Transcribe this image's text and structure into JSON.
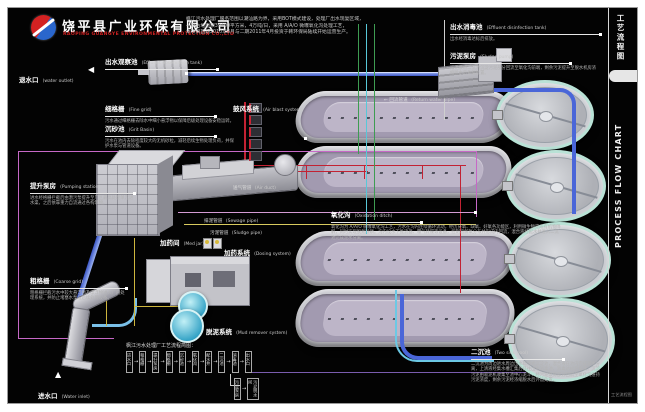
{
  "header": {
    "company_cn": "饶平县广业环保有限公司",
    "company_en": "RAOPING GUANGYE ENVIRONMENTAL PROTECTION CO.,LTD",
    "description_lines": [
      "枫江污水处理厂服务范围以潮汕路为界，采用BOT模式建设，处理厂出水现复区域，",
      "一期占地面积39400平方米，4万吨/日，采用 A/A/O 微曝氧化沟处理工艺，",
      "本项目首期2010年3月与二期2011年4月投资于韩环保局陆续开始运营生产。"
    ]
  },
  "sidebar": {
    "title_cn": "工艺流程图",
    "title_en": "PROCESS FLOW CHART",
    "footer": "工艺流程图"
  },
  "labels": {
    "observation_tank": {
      "cn": "出水观察池",
      "en": "(Effluent observation tank)"
    },
    "water_outlet": {
      "cn": "退水口",
      "en": "(water outlet)",
      "arrow": "◀"
    },
    "fine_grid": {
      "cn": "细格栅",
      "en": "(Fine grid)",
      "desc": "污水通过细格栅去除水中细小悬浮物以保障后级处理设备安稳运转。"
    },
    "grit_basin": {
      "cn": "沉砂池",
      "en": "(Grit Basin)",
      "desc": "污水在池内去除密度较大的无机砂粒，减轻后续生物处理负荷，并保护水泵与管道设备。"
    },
    "air_blast": {
      "cn": "鼓风系统",
      "en": "(Air blast system)"
    },
    "air_duct": {
      "cn": "送气管道",
      "en": "(Air duct)"
    },
    "pumping_station": {
      "cn": "提升泵房",
      "en": "(Pumping station)",
      "desc": "进水经格栅拦截后由潜污泵提升至厂区最高处理单元进水渠，之后依靠重力自流通过各构筑物。"
    },
    "coarse_grid": {
      "cn": "粗格栅",
      "en": "(Coarse grid)",
      "desc": "粗格栅拦截污水中较大悬浮物及漂浮物进入厂内处理系统，并防止堵塞水泵与后续处理设备。"
    },
    "water_inlet": {
      "cn": "进水口",
      "en": "(Water inlet)",
      "arrow": "▲"
    },
    "sewage_pipe": {
      "cn": "排泥管道",
      "en": "(Sewage pipe)"
    },
    "sludge_pipe": {
      "cn": "污泥管道",
      "en": "(Sludge pipe)"
    },
    "med_jar": {
      "cn": "加药间",
      "en": "(Med jar)"
    },
    "dosing_system": {
      "cn": "加药系统",
      "en": "(Dosing system)"
    },
    "mud_remover": {
      "cn": "脱泥系统",
      "en": "(Mud remover system)"
    },
    "oxidation_ditch": {
      "cn": "氧化沟",
      "en": "(Oxidation ditch)",
      "desc": "氧化沟为 A/A/O 微曝氧化沟工艺，污水在沟内连续循环流动，经历厌氧、缺氧、好氧各功能区，利用微生物完成有机物降解，同时实现脱氮除磷。沟内设水下推流器、曝气转碟等设备，控制溶解氧分布并形成内回流，混合液经配水井进入二沉池完成泥水分离。"
    },
    "return_pipe": {
      "cn": "回流管道",
      "en": "(Return water pipe)",
      "arrow": "←"
    },
    "disinfection_tank": {
      "cn": "出水消毒池",
      "en": "(Effluent disinfection tank)",
      "desc": "出水经消毒达标后排放。"
    },
    "sludge_pump": {
      "cn": "污泥泵房",
      "en": "(Sludge pump)",
      "desc": "污泥泵将二沉池沉淀污泥部分回流至氧化沟前端，剩余污泥提升至脱水机房浓缩脱水后外运处置。"
    },
    "secondary_tank": {
      "cn": "二沉池",
      "en": "(Two sink pool)",
      "desc": "二沉池为周边进水周边出水辐流式沉淀池，混合液在池内完成泥水分离，上清液经集水槽汇集后排往出水消毒池，消毒达标后排放；沉淀污泥由吸泥机收集至池中心泥斗，经污泥泵房部分回流至氧化沟维持污泥浓度，剩余污泥经浓缩脱水后外运处置。"
    }
  },
  "mini_flow": {
    "title": "枫江污水处理厂工艺流程简图：",
    "steps": [
      "进水口",
      "粗格栅",
      "提升泵房",
      "细格栅",
      "沉砂池",
      "氧化沟",
      "配水井",
      "二沉池",
      "消毒池",
      "出水口"
    ],
    "branch_steps": [
      "污泥泵房",
      "污泥脱水间"
    ]
  },
  "colors": {
    "water_pipe": "#4a66d8",
    "air_pipe": "#c22233",
    "sludge_pipe": "#d8ca5e",
    "return_pipe": "#c668c6",
    "brand_red": "#d32222",
    "brand_blue": "#2a66cc"
  }
}
